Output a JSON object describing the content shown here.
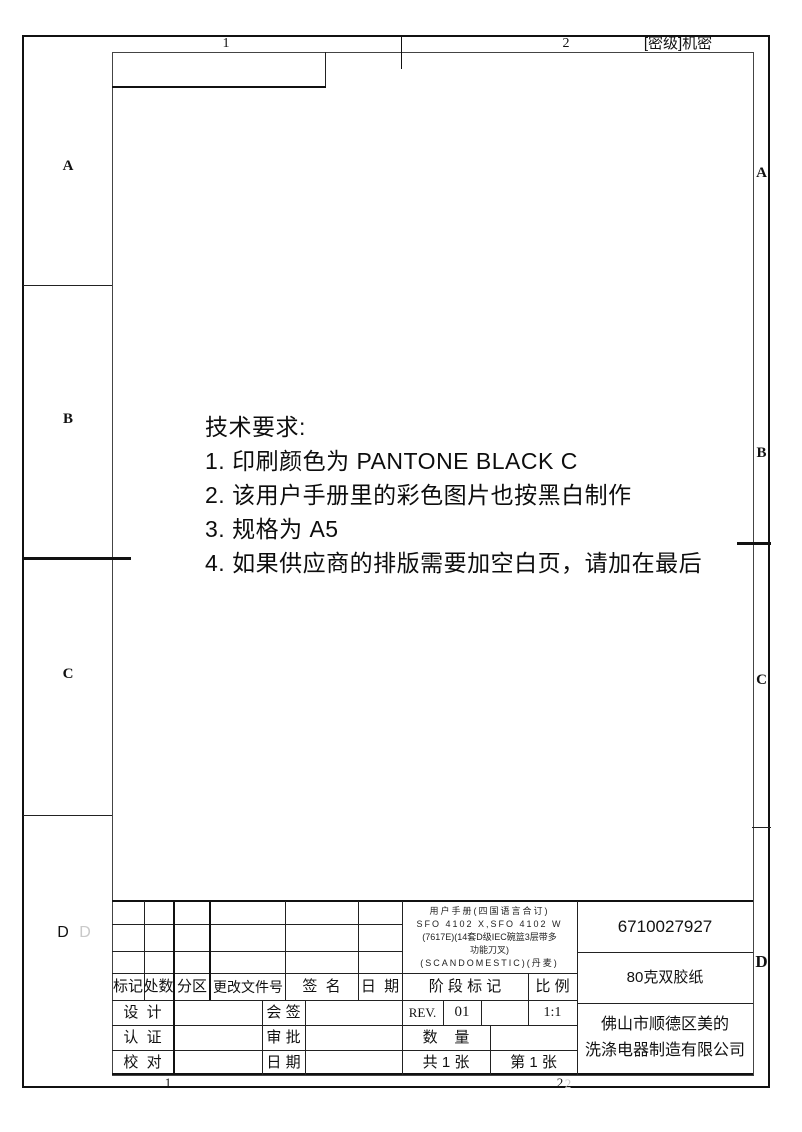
{
  "frame": {
    "security_label": "[密级]机密",
    "zone_top": [
      "1",
      "2"
    ],
    "zone_bottom": [
      "1",
      "2"
    ],
    "zone_left": [
      "A",
      "B",
      "C",
      "D"
    ],
    "zone_right": [
      "A",
      "B",
      "C",
      "D"
    ],
    "artifacts": {
      "ghost_d": "D",
      "ghost_2": "2"
    }
  },
  "tech_requirements": {
    "heading": "技术要求:",
    "items": [
      "1. 印刷颜色为  PANTONE BLACK C",
      "2. 该用户手册里的彩色图片也按黑白制作",
      "3. 规格为  A5",
      "4. 如果供应商的排版需要加空白页，请加在最后"
    ]
  },
  "title_block": {
    "revision_header": [
      "标记",
      "处数",
      "分区",
      "更改文件号",
      "签  名",
      "日  期"
    ],
    "sign_rows": [
      {
        "label1": "设  计",
        "label2": "会 签"
      },
      {
        "label1": "认  证",
        "label2": "审 批"
      },
      {
        "label1": "校  对",
        "label2": "日 期"
      }
    ],
    "stage": {
      "stage_header": "阶 段 标 记",
      "scale_header": "比 例",
      "rev_label": "REV.",
      "rev_value": "01",
      "scale_value": "1:1",
      "quantity_label": "数    量",
      "sheets_total": "共 1 张",
      "sheet_number": "第 1 张"
    },
    "title_lines": [
      "用户手册(四国语言合订)",
      "SFO 4102 X,SFO 4102 W",
      "(7617E)(14套D级IEC碗篮3层带多",
      "功能刀叉)",
      "(SCANDOMESTIC)(丹麦)"
    ],
    "part_number": "6710027927",
    "paper_spec": "80克双胶纸",
    "company_lines": [
      "佛山市顺德区美的",
      "洗涤电器制造有限公司"
    ]
  },
  "colors": {
    "line": "#111111",
    "thin_line": "#444444",
    "ghost": "#c9c9c9"
  }
}
